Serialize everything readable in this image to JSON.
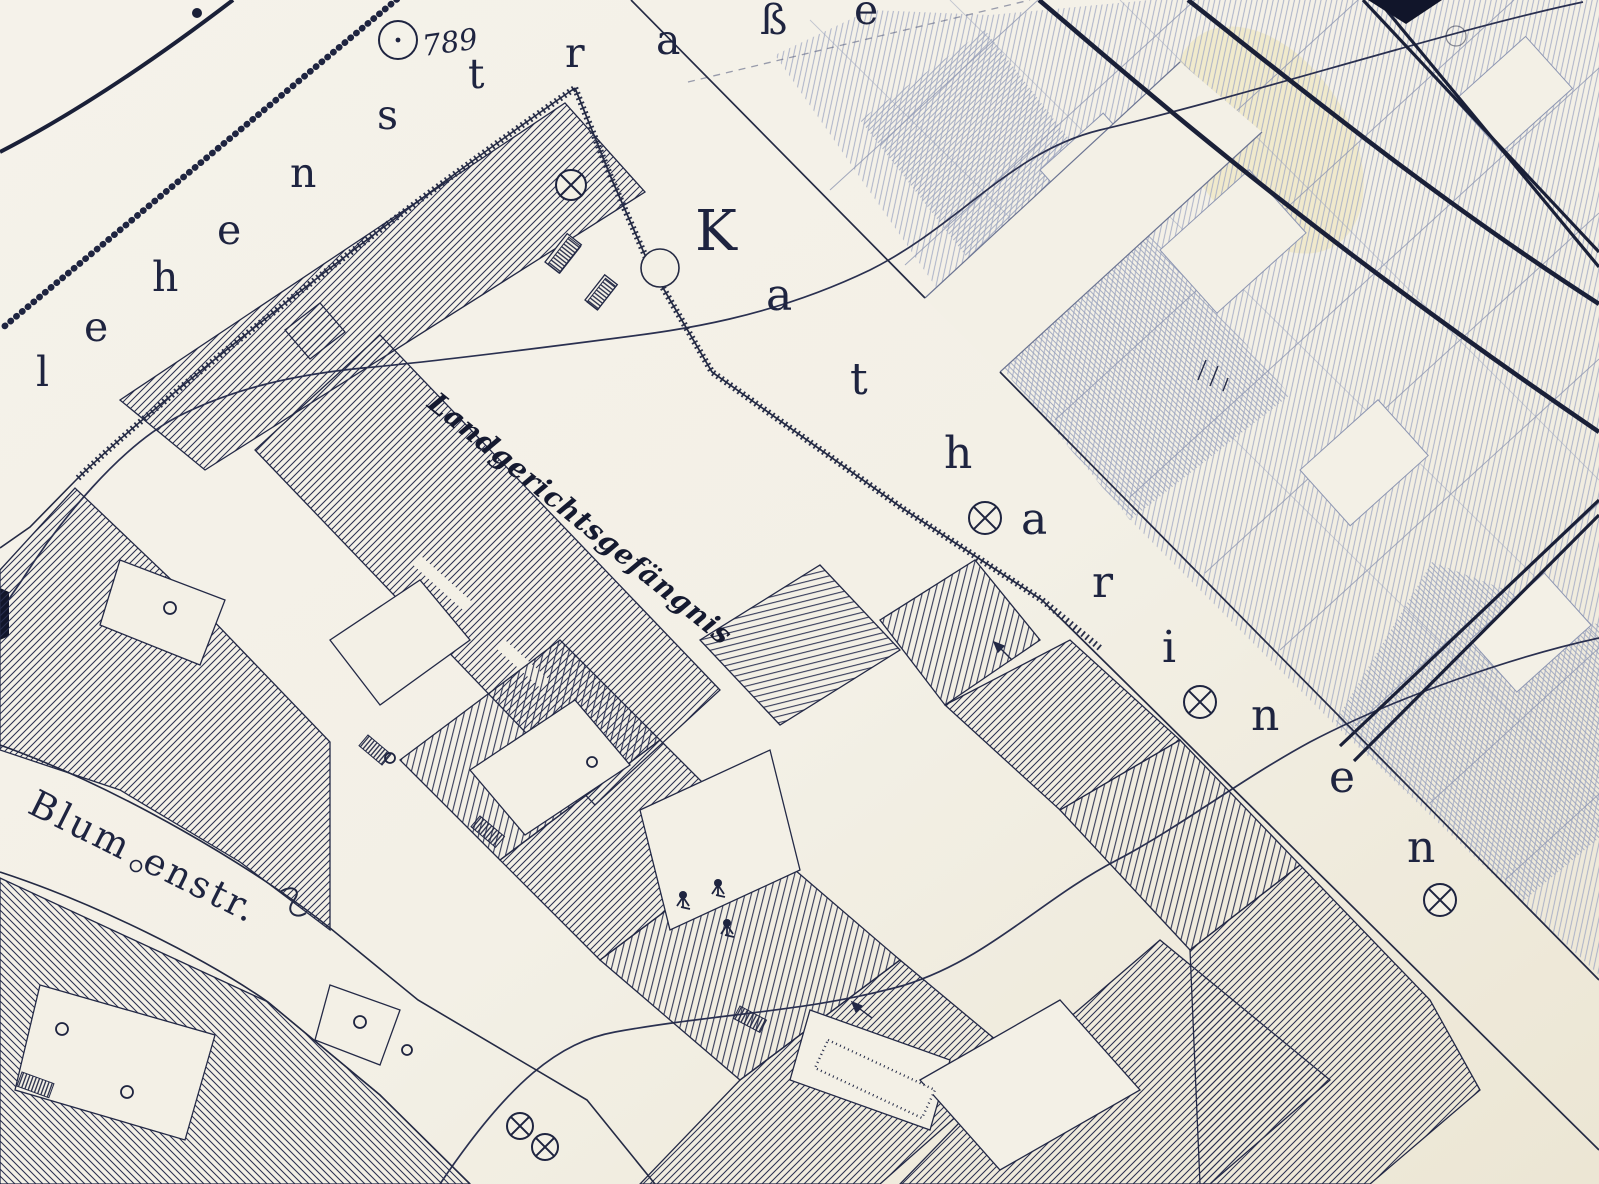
{
  "map": {
    "type": "historical-cadastral-city-map",
    "colors": {
      "paper": "#f3f0e6",
      "paper_shade": "#e9e3d2",
      "ink": "#1e2440",
      "ink_soft": "#2a3050",
      "faint_ink": "#97a0bb",
      "stain_yellow": "#e8d98a"
    },
    "labels": {
      "prison": {
        "text": "Landgerichtsgefängnis"
      },
      "marker789": {
        "text": "789"
      },
      "blumenstrasse": {
        "text": "Blumenstr.",
        "parts": [
          "Blum",
          "enstr."
        ]
      }
    },
    "streets": {
      "lehenstrasse": {
        "text": "lehenstraße",
        "letters": [
          {
            "c": "l",
            "x": 36,
            "y": 386
          },
          {
            "c": "e",
            "x": 84,
            "y": 341
          },
          {
            "c": "h",
            "x": 152,
            "y": 291
          },
          {
            "c": "e",
            "x": 217,
            "y": 244
          },
          {
            "c": "n",
            "x": 290,
            "y": 187
          },
          {
            "c": "s",
            "x": 377,
            "y": 129
          },
          {
            "c": "t",
            "x": 468,
            "y": 88
          },
          {
            "c": "r",
            "x": 565,
            "y": 67
          },
          {
            "c": "a",
            "x": 656,
            "y": 54
          },
          {
            "c": "ß",
            "x": 760,
            "y": 34
          },
          {
            "c": "e",
            "x": 854,
            "y": 24
          }
        ]
      },
      "katharinenstrasse": {
        "text": "Katharinen",
        "letters": [
          {
            "c": "K",
            "x": 695,
            "y": 250
          },
          {
            "c": "a",
            "x": 766,
            "y": 310
          },
          {
            "c": "t",
            "x": 850,
            "y": 394
          },
          {
            "c": "h",
            "x": 944,
            "y": 468
          },
          {
            "c": "a",
            "x": 1021,
            "y": 534
          },
          {
            "c": "r",
            "x": 1092,
            "y": 597
          },
          {
            "c": "i",
            "x": 1162,
            "y": 662
          },
          {
            "c": "n",
            "x": 1251,
            "y": 730
          },
          {
            "c": "e",
            "x": 1329,
            "y": 792
          },
          {
            "c": "n",
            "x": 1407,
            "y": 862
          }
        ]
      }
    },
    "symbols": {
      "manholes": [
        {
          "x": 571,
          "y": 185,
          "r": 15
        },
        {
          "x": 985,
          "y": 518,
          "r": 16
        },
        {
          "x": 1200,
          "y": 702,
          "r": 16
        },
        {
          "x": 1440,
          "y": 900,
          "r": 16
        },
        {
          "x": 520,
          "y": 1126,
          "r": 13
        },
        {
          "x": 545,
          "y": 1147,
          "r": 13
        }
      ],
      "survey_circles": [
        {
          "x": 170,
          "y": 608,
          "r": 6
        },
        {
          "x": 360,
          "y": 1022,
          "r": 6
        },
        {
          "x": 62,
          "y": 1029,
          "r": 6
        },
        {
          "x": 127,
          "y": 1092,
          "r": 6
        },
        {
          "x": 407,
          "y": 1050,
          "r": 5
        },
        {
          "x": 390,
          "y": 758,
          "r": 5
        },
        {
          "x": 592,
          "y": 762,
          "r": 5
        },
        {
          "x": 1456,
          "y": 36,
          "r": 10,
          "faint": true
        }
      ],
      "trees": [
        {
          "x": 683,
          "y": 897
        },
        {
          "x": 718,
          "y": 885
        },
        {
          "x": 727,
          "y": 925
        }
      ],
      "marker789_pos": {
        "x": 398,
        "y": 40,
        "r": 19
      }
    }
  }
}
